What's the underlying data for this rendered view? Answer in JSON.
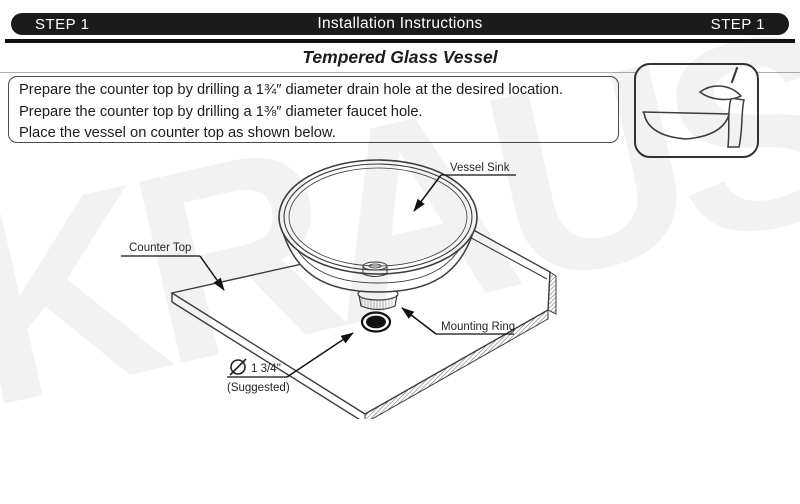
{
  "header": {
    "step_left": "STEP 1",
    "title": "Installation Instructions",
    "step_right": "STEP 1"
  },
  "section_title": "Tempered Glass Vessel",
  "instructions": {
    "lines": [
      "Prepare the counter top by drilling a 1¾″ diameter drain hole at the desired location.",
      "Prepare the counter top by drilling a 1⅜″ diameter faucet hole.",
      "Place the vessel on counter top as shown below."
    ]
  },
  "diagram": {
    "labels": {
      "vessel_sink": "Vessel Sink",
      "counter_top": "Counter Top",
      "mounting_ring": "Mounting Ring",
      "drain_diameter": "1 3/4''",
      "drain_suggested": "(Suggested)"
    }
  },
  "icons": {
    "product": "vessel-sink-with-waterfall-faucet-icon",
    "diameter_symbol": "diameter-symbol-icon"
  },
  "watermark": "KRAUS",
  "colors": {
    "header_bg": "#1b1b1b",
    "header_text": "#ffffff",
    "line_work": "#3d3d3d",
    "text": "#1c1c1c",
    "hatch": "#666666"
  }
}
